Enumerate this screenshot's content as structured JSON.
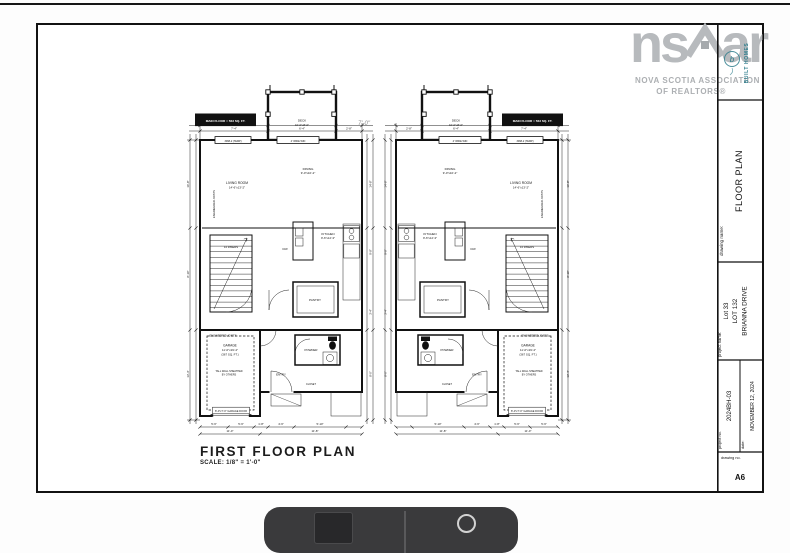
{
  "page": {
    "background": "#ffffff",
    "top_rule_color": "#161616"
  },
  "logo": {
    "brand_left": "ns",
    "brand_right": "ar",
    "house_icon": "house-roof-icon",
    "line1": "NOVA SCOTIA ASSOCIATION",
    "line2": "OF REALTORS®",
    "color": "#b7babd"
  },
  "builder": {
    "vertical_text": "BUILT HOMES",
    "monogram_letter": "b",
    "color": "#2e7d8c"
  },
  "title_block": {
    "drawing_name_label": "drawing name:",
    "drawing_name": "FLOOR PLAN",
    "project_name_label": "project name:",
    "project_line1": "Lot 33",
    "project_line2": "LOT 132",
    "project_line3": "BRIANNA DRIVE",
    "project_no_label": "project no.",
    "project_no": "2024BH-03",
    "date_label": "date:",
    "date_value": "NOVEMBER 12, 2024",
    "drawing_no_label": "drawing no.",
    "drawing_no": "A6"
  },
  "drawing": {
    "title": "FIRST FLOOR PLAN",
    "scale": "SCALE: 1/8\" = 1'-0\"",
    "between_units_dim": "7'-0\"",
    "labels": {
      "main_floor": "MAIN FLOOR = 563 SQ. FT.",
      "deck_name": "DECK",
      "deck_dims": "10'-0\"x8'-0\"",
      "living_name": "LIVING ROOM",
      "living_dims": "14'-6\"x13'-2\"",
      "dining_name": "DINING",
      "dining_dims": "9'-0\"x10'-2\"",
      "kitchen_name": "KITCHEN",
      "kitchen_dims": "9'-6\"x12'-3\"",
      "dishwasher": "D/W",
      "stairs": "14 RISERS",
      "joists": "ENGINEERED JOISTS",
      "pantry": "PANTRY",
      "powder": "POWDER",
      "entry": "ENTRY",
      "closet": "CLOSET",
      "garage_name": "GARAGE",
      "garage_dims": "11'-0\"x19'-4\"",
      "garage_area": "(367 SQ. FT.)",
      "tall_wall_1": "TALL WALL SHEATHED",
      "tall_wall_2": "BY OTHERS",
      "garage_door": "8'-0\"x7'-0\" GARAGE DOOR",
      "window_1": "3068-2 (TEMP)",
      "window_2": "4' WIDE WIN",
      "dim_top_1": "7'-4\"",
      "dim_top_2": "6'-4\"",
      "dim_top_3": "2'-8\"",
      "dim_top_overall": "11'-4\"",
      "dim_bottom_1": "5'-6\"",
      "dim_bottom_2": "5'-6\"",
      "dim_bottom_3": "1'-8\"",
      "dim_bottom_4": "4'-6\"",
      "dim_bottom_5": "5'-10\"",
      "dim_bottom_total_1": "11'-0\"",
      "dim_bottom_total_2": "11'-8\"",
      "dim_left_1": "16'-8\"",
      "dim_left_2": "8'-10\"",
      "dim_left_3": "13'-4\"",
      "dim_right_1": "14'-8\"",
      "dim_right_2": "9'-8\"",
      "dim_right_3": "3'-4\"",
      "dim_right_4": "8'-0\""
    }
  }
}
